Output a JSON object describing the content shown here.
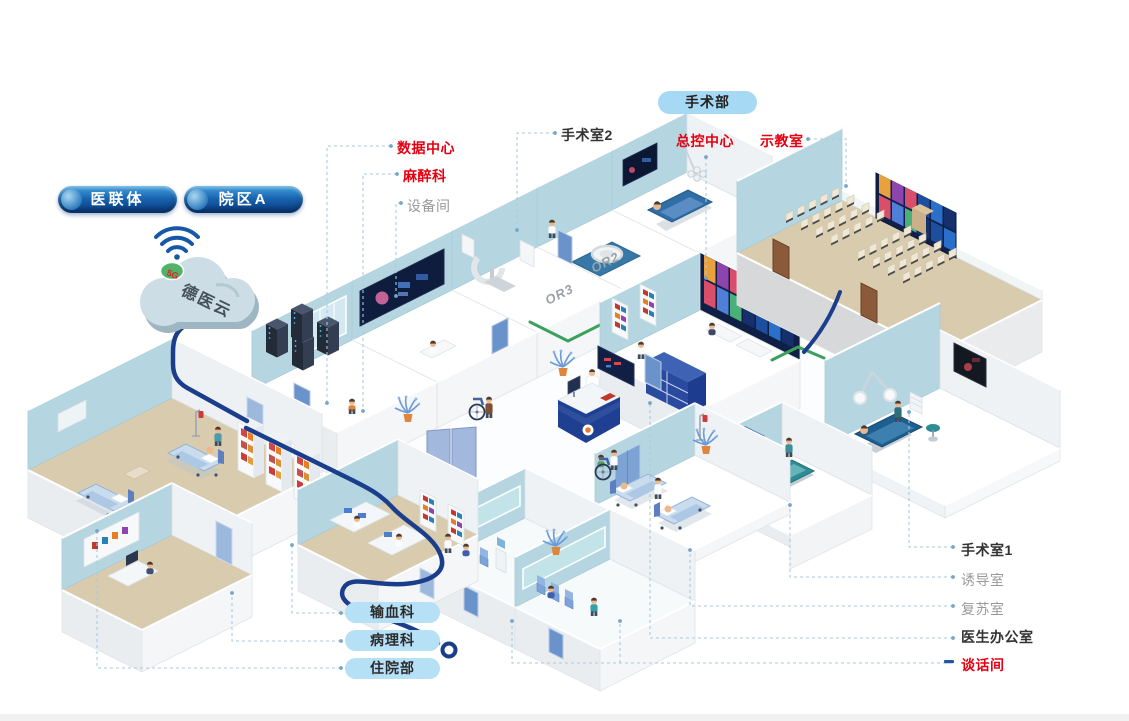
{
  "badges": {
    "alliance": "医联体",
    "campus": "院区A"
  },
  "cloud": {
    "name": "德医云",
    "chip": "5G"
  },
  "surgery_department_pill": "手术部",
  "callouts": {
    "data_center": "数据中心",
    "anesthesia": "麻醉科",
    "equipment_room": "设备间",
    "operating_room_2": "手术室2",
    "master_control": "总控中心",
    "demo_classroom": "示教室",
    "operating_room_1": "手术室1",
    "induction_room": "诱导室",
    "recovery_room": "复苏室",
    "doctor_office": "医生办公室",
    "talk_room": "谈话间"
  },
  "department_pills": [
    "输血科",
    "病理科",
    "住院部"
  ],
  "room_wall_marks": {
    "or3": "OR3",
    "or2": "OR2"
  },
  "colors": {
    "callout_red": "#e60012",
    "callout_dark": "#333333",
    "callout_gray": "#9a9a9a",
    "pill_light_blue": "#a6d9f3",
    "badge_navy": "#0d3e85",
    "cable_navy": "#1b3e8c",
    "cable_green": "#3da05e",
    "wall_blue": "#b5d6e0",
    "floor_tan": "#d9ccae"
  }
}
